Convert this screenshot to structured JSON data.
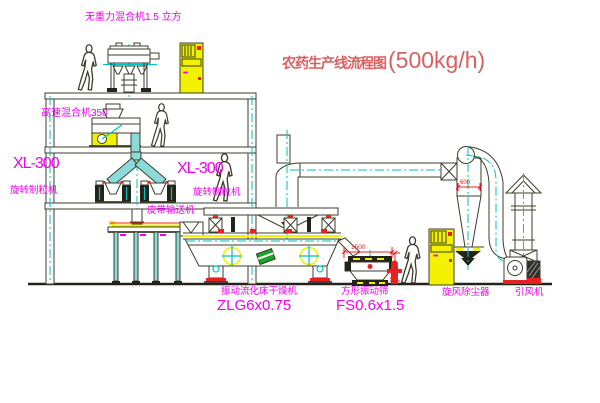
{
  "diagram": {
    "title": {
      "main": "农药生产线流程图",
      "capacity": "(500kg/h)"
    },
    "equipment": {
      "gravity_mixer": "无重力混合机1.5 立方",
      "high_speed_mixer": "高速混合机350",
      "granulator_left_model": "XL-300",
      "granulator_left_name": "旋转制粒机",
      "granulator_right_model": "XL-300",
      "granulator_right_name": "旋转制粒机",
      "belt_conveyor": "皮带输送机",
      "dryer_name": "振动流化床干燥机",
      "dryer_model": "ZLG6x0.75",
      "screen_name": "方形振动筛",
      "screen_model": "FS0.6x1.5",
      "cyclone": "旋风除尘器",
      "fan": "引风机"
    },
    "dimensions": {
      "screen_length": "1500",
      "screen_height": "540",
      "cyclone_body": "600"
    },
    "cabinet_marking": "•••",
    "colors": {
      "line": "#3c3c2c",
      "centerline": "#00c2c2",
      "label_magenta": "#f000f0",
      "dimension_red": "#e82020",
      "highlight_yellow": "#f2f200",
      "title_red": "#d96060",
      "tube_cyan": "#8adada",
      "green_box": "#1fa32a"
    }
  }
}
